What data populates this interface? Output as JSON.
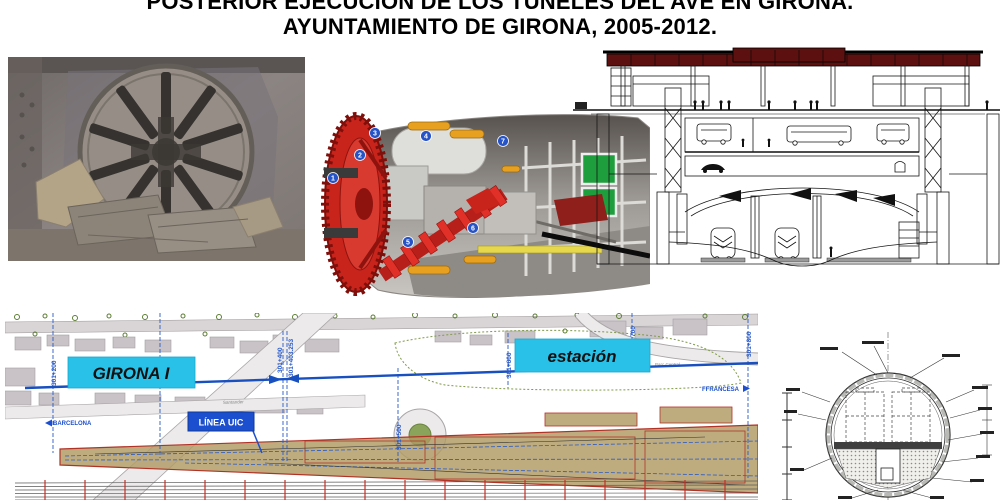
{
  "title": {
    "line1": "POSTERIOR EJECUCIÓN DE LOS TÚNELES DEL AVE EN GIRONA.",
    "line2": "AYUNTAMIENTO DE GIRONA, 2005-2012."
  },
  "tbm_diagram": {
    "labels": [
      "1",
      "2",
      "3",
      "4",
      "5",
      "6",
      "7"
    ]
  },
  "map": {
    "labels": {
      "girona": "GIRONA I",
      "estacion": "estación",
      "linea_uic": "LÍNEA UIC",
      "barcelona": "BARCELONA",
      "ffrancesa": "FFRANCESA",
      "parc_central": "Parc Central",
      "santander": "Santander"
    },
    "chainages": [
      "301+200",
      "301+300",
      "301+400",
      "301+403.253",
      "301+500",
      "301+600",
      "700",
      "301+800"
    ]
  },
  "colors": {
    "cyan_label": "#29c1e8",
    "uic_blue": "#1b4fd0",
    "alignment_blue": "#1950c0",
    "roof_maroon": "#5c1110",
    "tbm_red": "#c8241c",
    "corridor_tan": "#b09a63",
    "corridor_red": "#b03226",
    "building_gray": "#c9c3c7"
  }
}
